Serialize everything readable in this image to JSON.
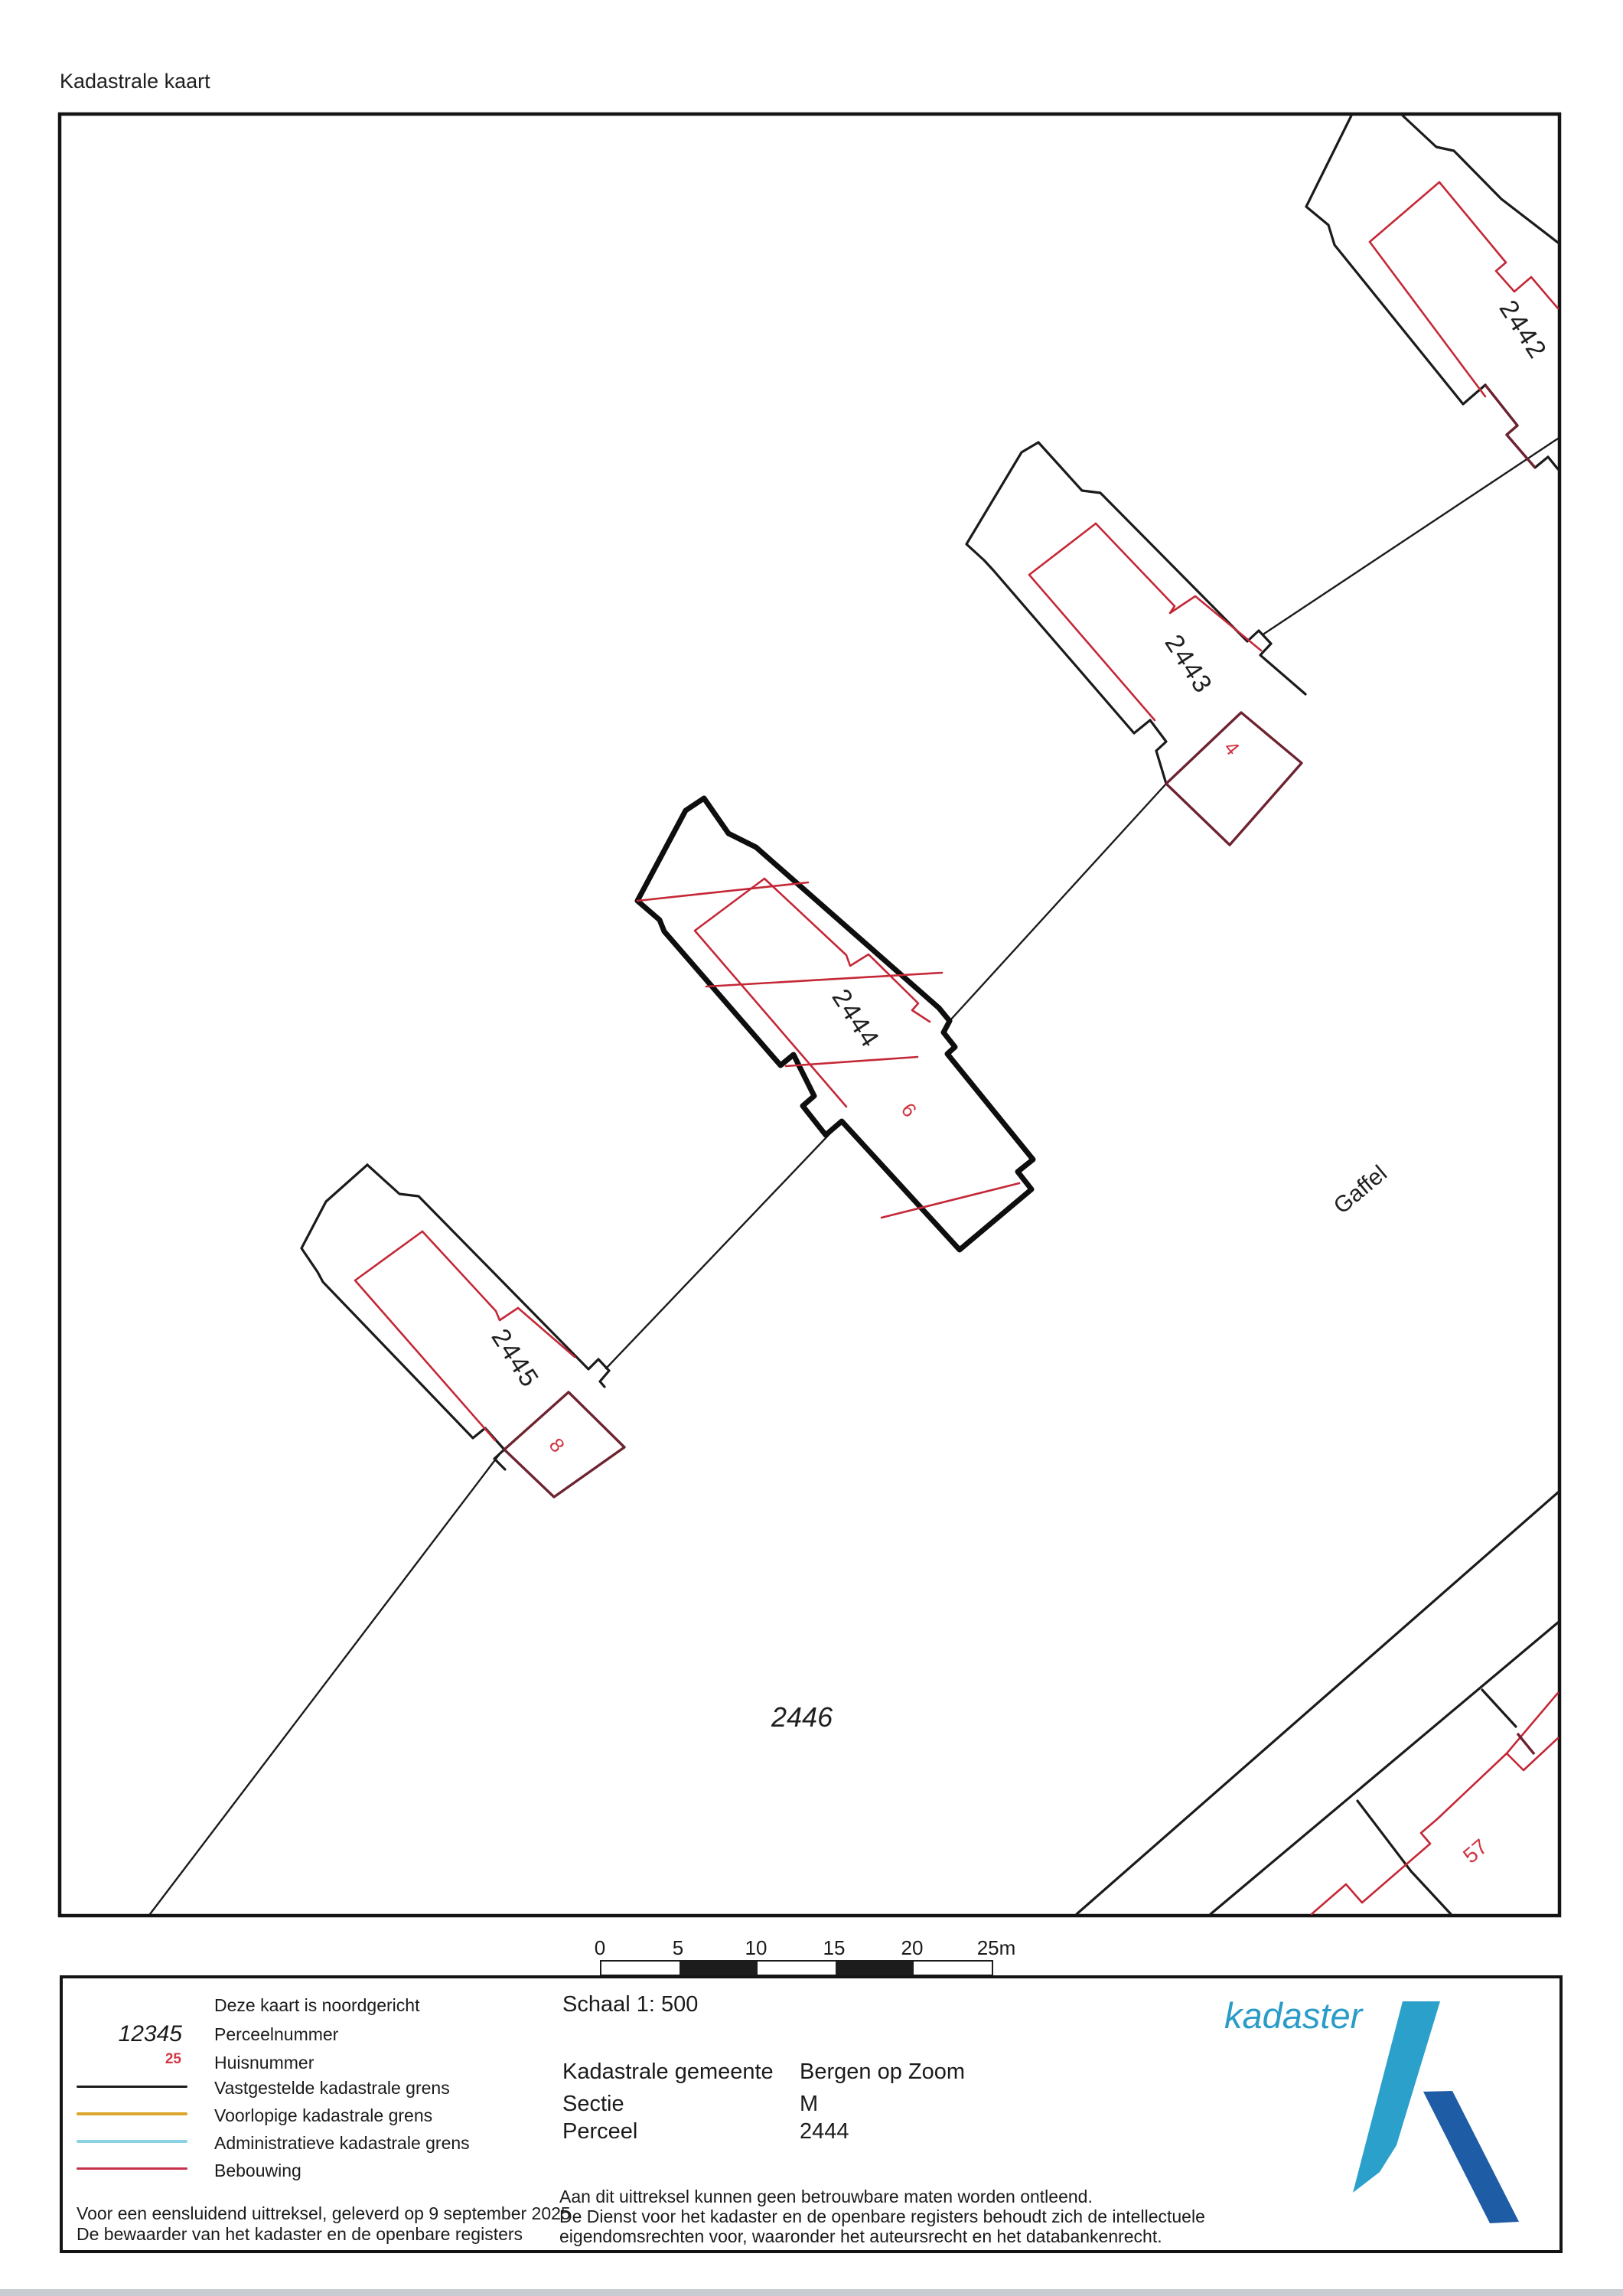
{
  "title": "Kadastrale kaart",
  "map": {
    "parcels": {
      "p2442": "2442",
      "p2443": "2443",
      "p2444": "2444",
      "p2445": "2445",
      "p2446": "2446"
    },
    "house_numbers": {
      "h4": "4",
      "h6": "6",
      "h8": "8",
      "h57": "57"
    },
    "street": "Gaffel"
  },
  "scalebar": {
    "ticks": [
      "0",
      "5",
      "10",
      "15",
      "20",
      "25m"
    ]
  },
  "legend": {
    "north_note": "Deze kaart is noordgericht",
    "items": [
      {
        "sample": "12345",
        "label": "Perceelnummer"
      },
      {
        "sample": "25",
        "label": "Huisnummer"
      },
      {
        "sample": "line-black",
        "label": "Vastgestelde kadastrale grens"
      },
      {
        "sample": "line-yellow",
        "label": "Voorlopige kadastrale grens"
      },
      {
        "sample": "line-cyan",
        "label": "Administratieve kadastrale grens"
      },
      {
        "sample": "line-red",
        "label": "Bebouwing"
      }
    ],
    "footer_line1": "Voor een eensluidend uittreksel, geleverd op 9 september 2025",
    "footer_line2": "De bewaarder van het kadaster en de openbare registers"
  },
  "info": {
    "scale_label": "Schaal 1: 500",
    "rows": [
      {
        "label": "Kadastrale gemeente",
        "value": "Bergen op Zoom"
      },
      {
        "label": "Sectie",
        "value": "M"
      },
      {
        "label": "Perceel",
        "value": "2444"
      }
    ],
    "disclaimer1": "Aan dit uittreksel kunnen geen betrouwbare maten worden ontleend.",
    "disclaimer2": "De Dienst voor het kadaster en de openbare registers behoudt zich de intellectuele",
    "disclaimer3": "eigendomsrechten voor, waaronder het auteursrecht en het databankenrecht."
  },
  "logo": {
    "text": "kadaster"
  },
  "colors": {
    "boundary": "#1b1b1b",
    "selected_boundary": "#0e0e0e",
    "building": "#c42837",
    "house_number": "#d03440",
    "dark_building": "#6e2430",
    "provisional": "#dca62b",
    "administrative": "#8ad2e2",
    "legend_red": "#c5314b",
    "logo_light": "#2a9fca",
    "logo_dark": "#1e5ca5"
  }
}
